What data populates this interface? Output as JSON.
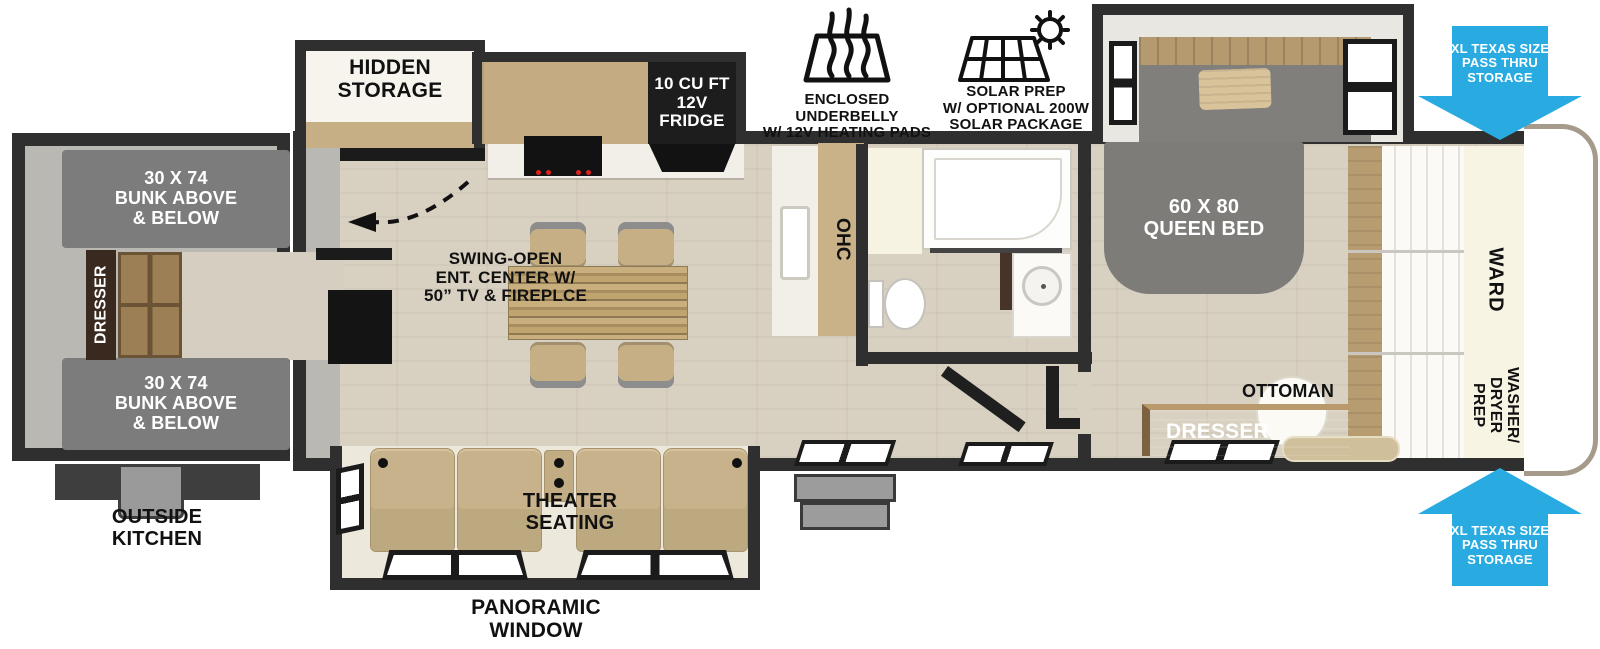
{
  "colors": {
    "accent_blue": "#29abe2",
    "wall_dark": "#2f2f2f",
    "floor_wood": "#d8d0c1",
    "interior_gray": "#b9b7b1",
    "cabinet_wood": "#c3aa81",
    "bunk_gray": "#7c7c7c",
    "seat_tan": "#c8b28b"
  },
  "callouts": {
    "underbelly": {
      "icon": "heating-pads-icon",
      "label": "ENCLOSED UNDERBELLY\nW/ 12V HEATING PADS"
    },
    "solar": {
      "icon": "solar-panel-sun-icon",
      "label": "SOLAR PREP\nW/ OPTIONAL 200W\nSOLAR PACKAGE"
    },
    "pass_thru_top": "XL TEXAS SIZE\nPASS THRU\nSTORAGE",
    "pass_thru_bottom": "XL TEXAS SIZE\nPASS THRU\nSTORAGE",
    "swing_open": "SWING-OPEN\nENT. CENTER W/\n50” TV & FIREPLCE",
    "panoramic_window": "PANORAMIC\nWINDOW",
    "outside_kitchen": "OUTSIDE\nKITCHEN"
  },
  "bunk_room": {
    "bunk_top": "30 X 74\nBUNK ABOVE\n& BELOW",
    "bunk_bottom": "30 X 74\nBUNK ABOVE\n& BELOW",
    "dresser": "DRESSER"
  },
  "living": {
    "hidden_storage": "HIDDEN\nSTORAGE",
    "fridge": "10 CU FT\n12V\nFRIDGE",
    "ohc": "OHC",
    "theater_seating": "THEATER\nSEATING"
  },
  "bedroom": {
    "queen_bed": "60 X 80\nQUEEN BED",
    "ottoman": "OTTOMAN",
    "dresser": "DRESSER",
    "ward": "WARD",
    "washer_dryer": "WASHER/\nDRYER\nPREP"
  }
}
